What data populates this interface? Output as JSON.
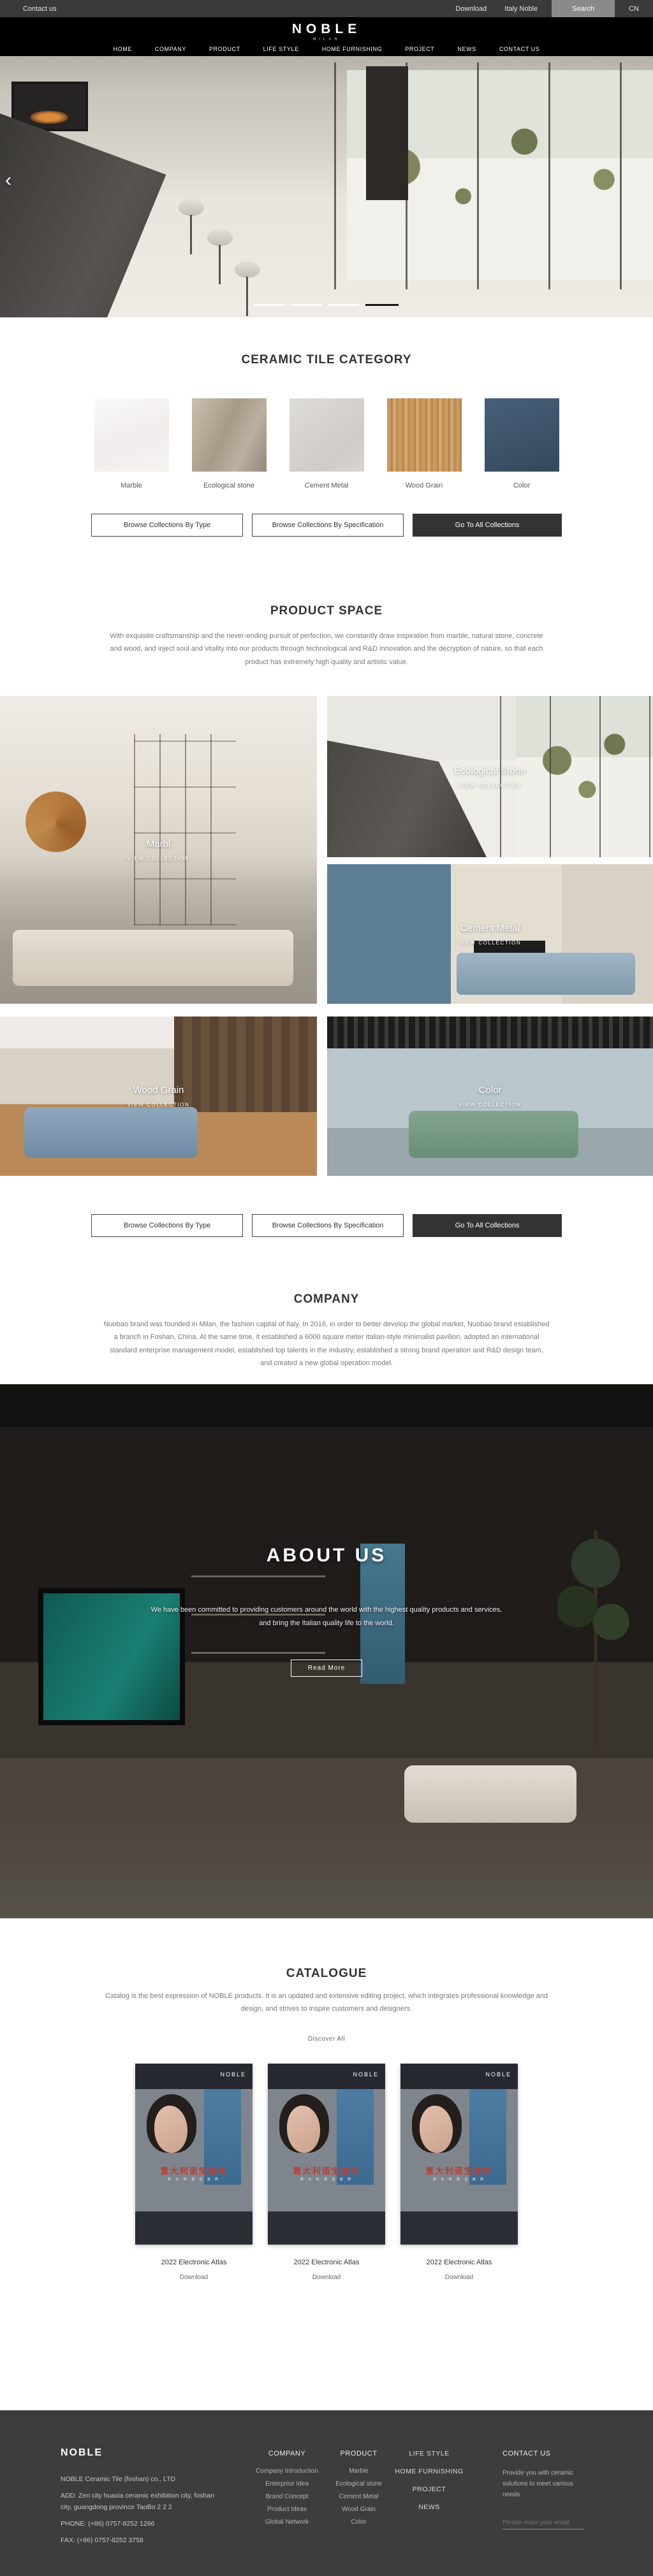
{
  "topbar": {
    "contact_us": "Contact us",
    "download": "Download",
    "italy_noble": "Italy Noble",
    "search": "Search",
    "lang": "CN"
  },
  "header": {
    "logo": "NOBLE",
    "tagline": "MILAN",
    "nav": [
      {
        "label": "HOME"
      },
      {
        "label": "COMPANY"
      },
      {
        "label": "PRODUCT"
      },
      {
        "label": "LIFE STYLE"
      },
      {
        "label": "HOME FURNISHING"
      },
      {
        "label": "PROJECT"
      },
      {
        "label": "NEWS"
      },
      {
        "label": "CONTACT US"
      }
    ]
  },
  "hero": {
    "prev": "‹"
  },
  "category": {
    "title": "CERAMIC TILE CATEGORY",
    "tiles": [
      {
        "label": "Marble"
      },
      {
        "label": "Ecological stone"
      },
      {
        "label": "Cement Metal"
      },
      {
        "label": "Wood Grain"
      },
      {
        "label": "Color"
      }
    ],
    "buttons": {
      "by_type": "Browse Collections By Type",
      "by_spec": "Browse Collections By Specification",
      "all": "Go To All Collections"
    }
  },
  "product_space": {
    "title": "PRODUCT SPACE",
    "description": "With exquisite craftsmanship and the never-ending pursuit of perfection, we constantly draw inspiration from marble, natural stone, concrete and wood, and inject soul and vitality into our products through technological and R&D innovation and the decryption of nature, so that each product has extremely high quality and artistic value.",
    "cards": [
      {
        "label": "Marbl",
        "cta": "VIEW COLLECTION"
      },
      {
        "label": "Ecological Stone",
        "cta": "VIEW COLLECTION"
      },
      {
        "label": "Cement Metal",
        "cta": "VIEW COLLECTION"
      },
      {
        "label": "Wood Grain",
        "cta": "VIEW COLLECTION"
      },
      {
        "label": "Color",
        "cta": "VIEW COLLECTION"
      }
    ]
  },
  "company": {
    "title": "COMPANY",
    "description": "Nuobao brand was founded in Milan, the fashion capital of Italy. In 2016, in order to better develop the global market, Nuobao brand established a branch in Foshan, China. At the same time, it established a 6000 square meter Italian-style minimalist pavilion, adopted an international standard enterprise management model, established top talents in the industry, established a strong brand operation and R&D design team, and created a new global operation model."
  },
  "about": {
    "title": "ABOUT US",
    "description": "We have been committed to providing customers around the world with the highest quality products and services, and bring the Italian quality life to the world.",
    "more": "Read More"
  },
  "catalogue": {
    "title": "CATALOGUE",
    "description": "Catalog is the best expression of NOBLE products. It is an updated and extensive editing project, which integrates professional knowledge and design, and strives to inspire customers and designers.",
    "discover": "Discover All",
    "cover": {
      "brand": "NOBLE",
      "title_cn": "意大利诺宝瓷砖",
      "subtitle_cn": "意 大 利 诺 宝 瓷 砖"
    },
    "items": [
      {
        "name": "2022 Electronic Atlas",
        "action": "Download"
      },
      {
        "name": "2022 Electronic Atlas",
        "action": "Download"
      },
      {
        "name": "2022 Electronic Atlas",
        "action": "Download"
      }
    ]
  },
  "footer": {
    "brand": "NOBLE",
    "company_name": "NOBLE Ceramic Tile (foshan) co., LTD",
    "address": "ADD:  Zen city huaxia ceramic exhibition city, foshan city, guangdong province TaoBo 2 2 2",
    "phone": "PHONE:   (+86)  0757-8252 1266",
    "fax": "FAX:   (+86)  0757-8252 3758",
    "company_col": {
      "title": "COMPANY",
      "items": [
        {
          "label": "Company Introduction"
        },
        {
          "label": "Enterprise Idea"
        },
        {
          "label": "Brand Concept"
        },
        {
          "label": "Product Ideas"
        },
        {
          "label": "Global Network"
        }
      ]
    },
    "product_col": {
      "title": "PRODUCT",
      "items": [
        {
          "label": "Marble"
        },
        {
          "label": "Ecological stone"
        },
        {
          "label": "Cement Metal"
        },
        {
          "label": "Wood Grain"
        },
        {
          "label": "Color"
        }
      ]
    },
    "links_col": {
      "items": [
        {
          "label": "LIFE STYLE"
        },
        {
          "label": "HOME FURNISHING"
        },
        {
          "label": "PROJECT"
        },
        {
          "label": "NEWS"
        }
      ]
    },
    "contact": {
      "title": "CONTACT US",
      "text": "Provide you with ceramic solutions to meet various needs",
      "email_placeholder": "Please enter your email"
    }
  }
}
